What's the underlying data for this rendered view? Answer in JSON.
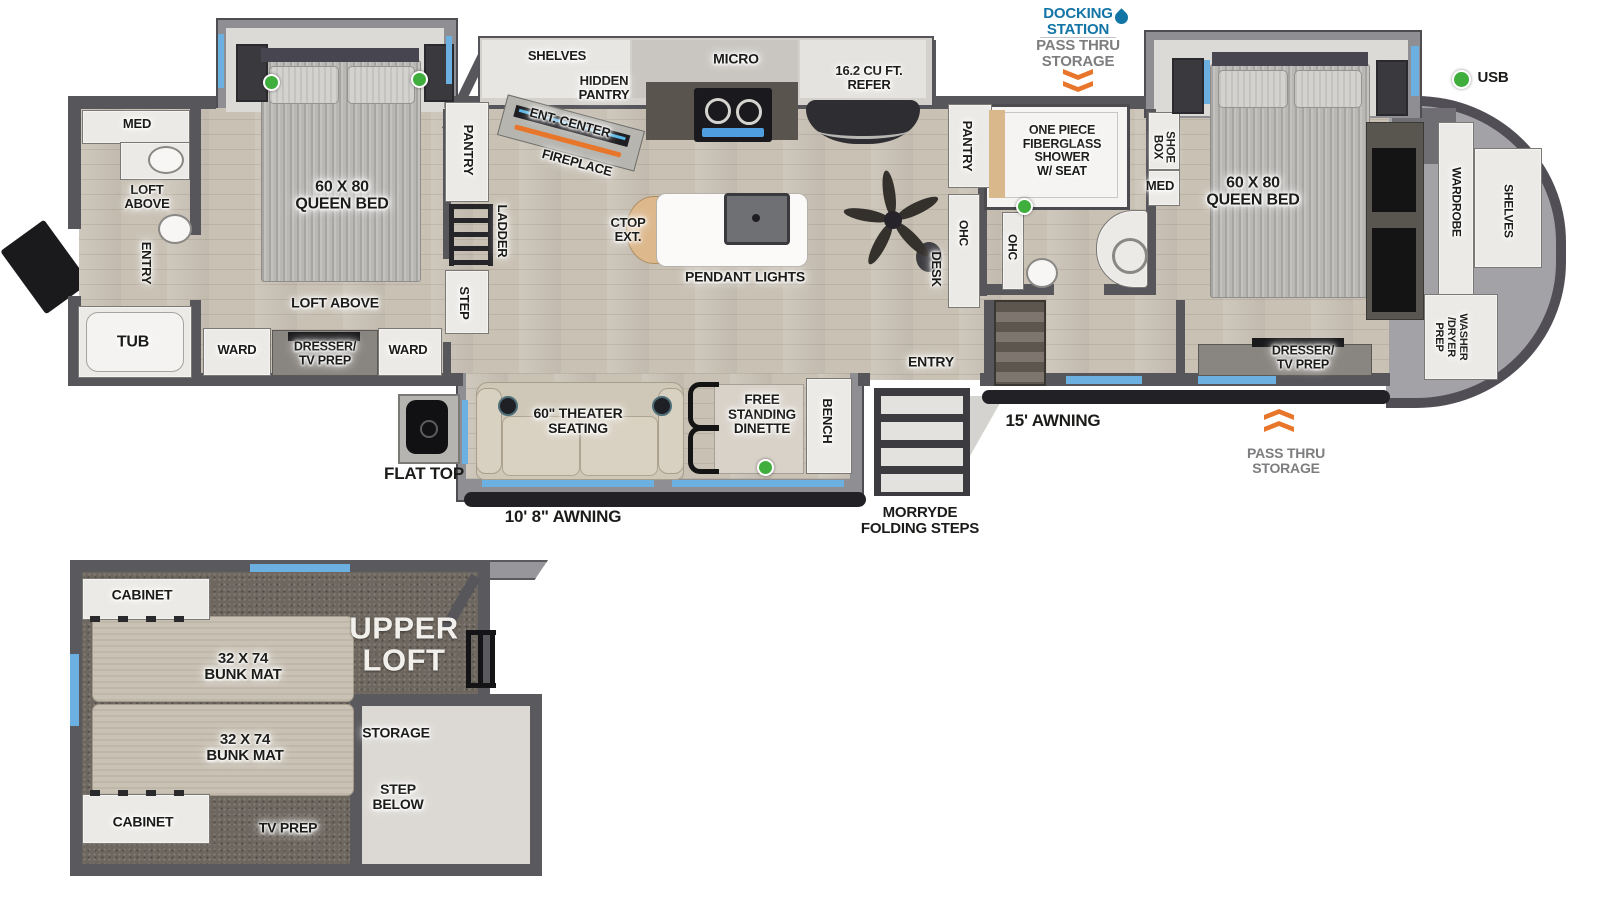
{
  "colors": {
    "wall": "#57565b",
    "floor": "#c9c1b4",
    "carpet": "#6e675f",
    "window_blue": "#6cb0e2",
    "usb_green": "#3fae3c",
    "arrow_orange": "#e8762a",
    "docking_blue": "#1375a6",
    "annotation_gray": "#7d7d7f"
  },
  "exterior": {
    "docking_station": "DOCKING\nSTATION",
    "pass_thru_top": "PASS THRU\nSTORAGE",
    "usb": "USB",
    "awning_rear": "10' 8\" AWNING",
    "folding_steps": "MORRYDE\nFOLDING STEPS",
    "awning_main": "15' AWNING",
    "pass_thru_front": "PASS THRU\nSTORAGE",
    "flat_top": "FLAT TOP"
  },
  "rear_bath": {
    "med": "MED",
    "loft_above": "LOFT\nABOVE",
    "entry": "ENTRY",
    "tub": "TUB"
  },
  "rear_bedroom": {
    "bed": "60 X 80\nQUEEN BED",
    "loft_above": "LOFT ABOVE",
    "ward_left": "WARD",
    "dresser": "DRESSER/\nTV PREP",
    "ward_right": "WARD",
    "pantry": "PANTRY",
    "ladder": "LADDER",
    "step": "STEP"
  },
  "kitchen": {
    "shelves": "SHELVES",
    "hidden_pantry": "HIDDEN\nPANTRY",
    "ent_center": "ENT. CENTER",
    "fireplace": "FIREPLACE",
    "micro": "MICRO",
    "refer": "16.2 CU FT.\nREFER",
    "ctop_ext": "CTOP\nEXT.",
    "pendant_lights": "PENDANT LIGHTS"
  },
  "living": {
    "pantry": "PANTRY",
    "ohc": "OHC",
    "desk": "DESK",
    "entry": "ENTRY",
    "theater_seating": "60\" THEATER\nSEATING",
    "dinette": "FREE\nSTANDING\nDINETTE",
    "bench": "BENCH"
  },
  "mid_bath": {
    "shower": "ONE PIECE\nFIBERGLASS\nSHOWER\nW/ SEAT",
    "ohc": "OHC",
    "shoe_box": "SHOE\nBOX",
    "med": "MED"
  },
  "front_bedroom": {
    "bed": "60 X 80\nQUEEN BED",
    "dresser": "DRESSER/\nTV PREP"
  },
  "front_closet": {
    "wardrobe": "WARDROBE",
    "shelves": "SHELVES",
    "washer_dryer": "WASHER\n/DRYER\nPREP"
  },
  "upper_loft": {
    "title": "UPPER\nLOFT",
    "cabinet_top": "CABINET",
    "bunk_top": "32 X 74\nBUNK MAT",
    "bunk_bottom": "32 X 74\nBUNK MAT",
    "storage": "STORAGE",
    "step_below": "STEP\nBELOW",
    "cabinet_bottom": "CABINET",
    "tv_prep": "TV PREP"
  }
}
